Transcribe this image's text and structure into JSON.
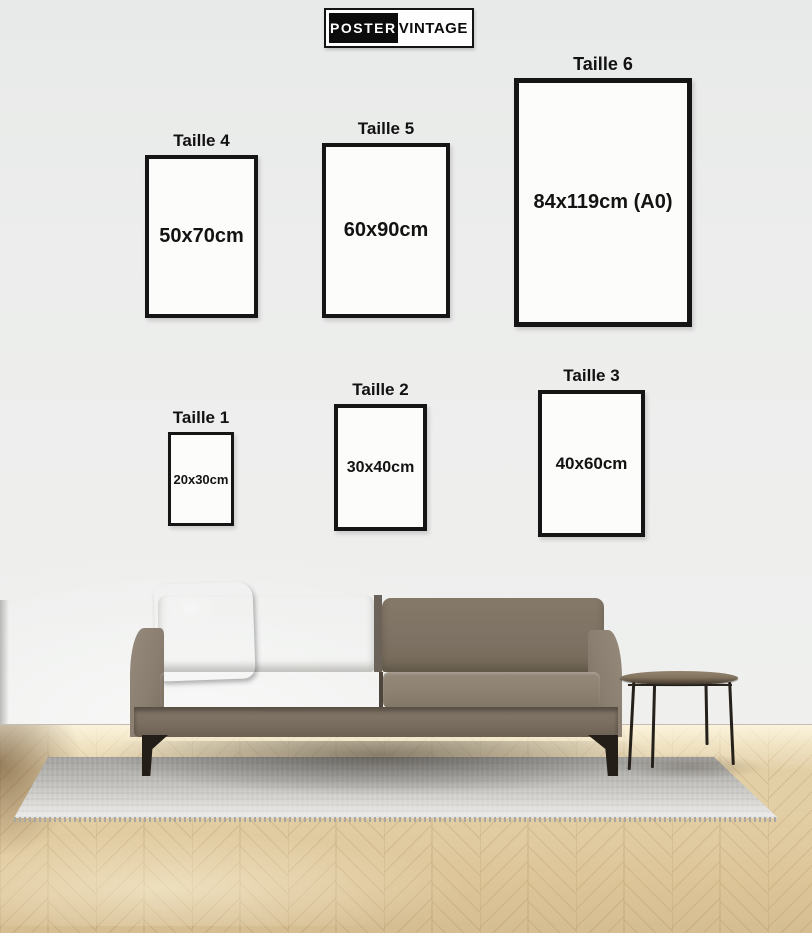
{
  "brand": {
    "segment_primary": "POSTER",
    "segment_secondary": "VINTAGE"
  },
  "size_guide": {
    "sizes": [
      {
        "label": "Taille 1",
        "dimensions": "20x30cm"
      },
      {
        "label": "Taille 2",
        "dimensions": "30x40cm"
      },
      {
        "label": "Taille 3",
        "dimensions": "40x60cm"
      },
      {
        "label": "Taille 4",
        "dimensions": "50x70cm"
      },
      {
        "label": "Taille 5",
        "dimensions": "60x90cm"
      },
      {
        "label": "Taille 6",
        "dimensions": "84x119cm (A0)"
      }
    ]
  },
  "scene": {
    "objects": [
      "sofa",
      "throw-pillow",
      "side-table",
      "area-rug",
      "herringbone-parquet-floor"
    ]
  },
  "colors": {
    "brand_black": "#0c0c0c",
    "wall": "#ebedec",
    "frame_border": "#151515",
    "frame_interior": "#fcfcfb",
    "sofa_fabric": "#847869",
    "pillow_blue": "#697c8f",
    "rug_gray": "#cfceca",
    "floor_wood": "#e3cfa6",
    "metal_legs": "#241e18"
  }
}
